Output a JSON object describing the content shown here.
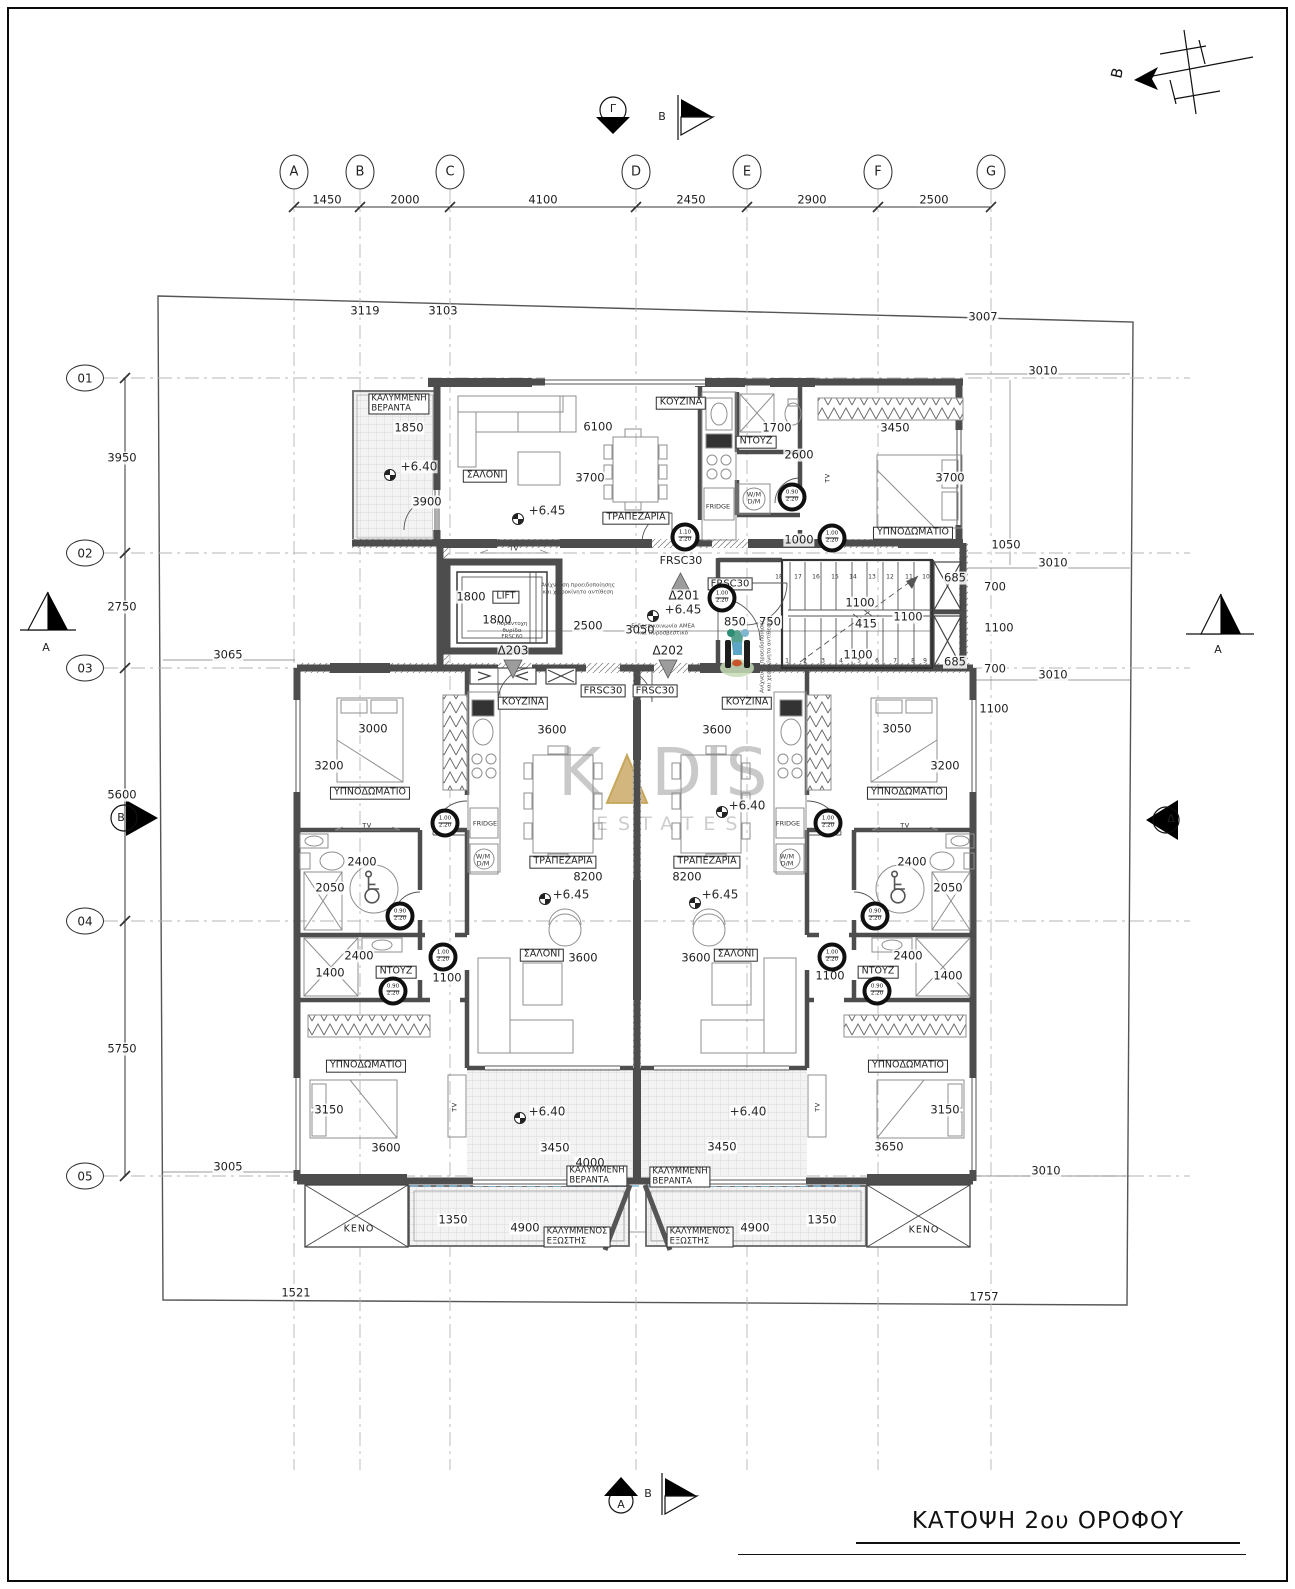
{
  "sheet": {
    "title": "ΚΑΤΟΨΗ 2ου ΟΡΟΦΟΥ"
  },
  "watermark": {
    "word_start": "K",
    "word_end": "DIS",
    "subtitle": "ESTATES"
  },
  "north_label": "B",
  "grid": {
    "columns": [
      {
        "label": "A",
        "x": 294
      },
      {
        "label": "B",
        "x": 360
      },
      {
        "label": "C",
        "x": 450
      },
      {
        "label": "D",
        "x": 636
      },
      {
        "label": "E",
        "x": 747
      },
      {
        "label": "F",
        "x": 878
      },
      {
        "label": "G",
        "x": 991
      }
    ],
    "rows": [
      {
        "label": "01",
        "y": 378
      },
      {
        "label": "02",
        "y": 553
      },
      {
        "label": "03",
        "y": 668
      },
      {
        "label": "04",
        "y": 921
      },
      {
        "label": "05",
        "y": 1176
      }
    ]
  },
  "stairs": {
    "top": {
      "y": 577,
      "xs": [
        779,
        798,
        816,
        835,
        853,
        872,
        890,
        909,
        926
      ],
      "nums": [
        "18",
        "17",
        "16",
        "15",
        "14",
        "13",
        "12",
        "11",
        "10"
      ]
    },
    "bottom": {
      "y": 661,
      "xs": [
        787,
        805,
        823,
        841,
        859,
        877,
        895,
        913,
        925
      ],
      "nums": [
        "1",
        "2",
        "3",
        "4",
        "5",
        "6",
        "7",
        "8",
        "9"
      ]
    }
  },
  "door_circles": [
    {
      "x": 685,
      "y": 537,
      "a": "1.10",
      "b": "2.20"
    },
    {
      "x": 792,
      "y": 497,
      "a": "0.90",
      "b": "2.20"
    },
    {
      "x": 832,
      "y": 538,
      "a": "1.00",
      "b": "2.20"
    },
    {
      "x": 722,
      "y": 598,
      "a": "1.00",
      "b": "2.20"
    },
    {
      "x": 445,
      "y": 823,
      "a": "1.00",
      "b": "2.20"
    },
    {
      "x": 400,
      "y": 916,
      "a": "0.90",
      "b": "2.20"
    },
    {
      "x": 443,
      "y": 957,
      "a": "1.00",
      "b": "2.20"
    },
    {
      "x": 393,
      "y": 991,
      "a": "0.90",
      "b": "2.20"
    },
    {
      "x": 828,
      "y": 823,
      "a": "1.00",
      "b": "2.20"
    },
    {
      "x": 875,
      "y": 916,
      "a": "0.90",
      "b": "2.20"
    },
    {
      "x": 832,
      "y": 957,
      "a": "1.00",
      "b": "2.20"
    },
    {
      "x": 877,
      "y": 991,
      "a": "0.90",
      "b": "2.20"
    }
  ],
  "labels": [
    {
      "t": "1450",
      "x": 327,
      "y": 200,
      "c": "dim"
    },
    {
      "t": "2000",
      "x": 405,
      "y": 200,
      "c": "dim"
    },
    {
      "t": "4100",
      "x": 543,
      "y": 200,
      "c": "dim"
    },
    {
      "t": "2450",
      "x": 691,
      "y": 200,
      "c": "dim"
    },
    {
      "t": "2900",
      "x": 812,
      "y": 200,
      "c": "dim"
    },
    {
      "t": "2500",
      "x": 934,
      "y": 200,
      "c": "dim"
    },
    {
      "t": "3119",
      "x": 365,
      "y": 311,
      "c": "dim"
    },
    {
      "t": "3103",
      "x": 443,
      "y": 311,
      "c": "dim"
    },
    {
      "t": "3007",
      "x": 983,
      "y": 317,
      "c": "dim"
    },
    {
      "t": "3950",
      "x": 122,
      "y": 458,
      "c": "dim"
    },
    {
      "t": "2750",
      "x": 122,
      "y": 607,
      "c": "dim"
    },
    {
      "t": "5600",
      "x": 122,
      "y": 795,
      "c": "dim"
    },
    {
      "t": "5750",
      "x": 122,
      "y": 1049,
      "c": "dim"
    },
    {
      "t": "3065",
      "x": 228,
      "y": 655,
      "c": "dim"
    },
    {
      "t": "3005",
      "x": 228,
      "y": 1167,
      "c": "dim"
    },
    {
      "t": "3010",
      "x": 1043,
      "y": 371,
      "c": "dim"
    },
    {
      "t": "1050",
      "x": 1006,
      "y": 545,
      "c": "dim"
    },
    {
      "t": "3010",
      "x": 1053,
      "y": 563,
      "c": "dim"
    },
    {
      "t": "3010",
      "x": 1053,
      "y": 675,
      "c": "dim"
    },
    {
      "t": "1100",
      "x": 994,
      "y": 709,
      "c": "dim"
    },
    {
      "t": "3010",
      "x": 1046,
      "y": 1171,
      "c": "dim"
    },
    {
      "t": "685",
      "x": 955,
      "y": 578,
      "c": "dim"
    },
    {
      "t": "700",
      "x": 995,
      "y": 587,
      "c": "dim"
    },
    {
      "t": "1100",
      "x": 999,
      "y": 628,
      "c": "dim"
    },
    {
      "t": "685",
      "x": 955,
      "y": 662,
      "c": "dim"
    },
    {
      "t": "700",
      "x": 995,
      "y": 669,
      "c": "dim"
    },
    {
      "t": "ΚΑΛΥΜΜΕΝΗ\nΒΕΡΑΝΤΑ",
      "x": 399,
      "y": 404,
      "c": "room2"
    },
    {
      "t": "1850",
      "x": 409,
      "y": 428,
      "c": "dim"
    },
    {
      "t": "+6.40",
      "x": 419,
      "y": 467,
      "c": "lvl"
    },
    {
      "t": "3900",
      "x": 427,
      "y": 502,
      "c": "dim"
    },
    {
      "t": "ΣΑΛΟΝΙ",
      "x": 485,
      "y": 476,
      "c": "room"
    },
    {
      "t": "6100",
      "x": 598,
      "y": 427,
      "c": "dim"
    },
    {
      "t": "3700",
      "x": 590,
      "y": 478,
      "c": "dim"
    },
    {
      "t": "+6.45",
      "x": 547,
      "y": 511,
      "c": "lvl"
    },
    {
      "t": "ΤΡΑΠΕΖΑΡΙΑ",
      "x": 636,
      "y": 518,
      "c": "room"
    },
    {
      "t": "TV",
      "x": 514,
      "y": 549,
      "c": "tv"
    },
    {
      "t": "ΚΟΥΖΙΝΑ",
      "x": 681,
      "y": 403,
      "c": "room"
    },
    {
      "t": "1700",
      "x": 777,
      "y": 428,
      "c": "dim"
    },
    {
      "t": "ΝΤΟΥΖ",
      "x": 756,
      "y": 442,
      "c": "room"
    },
    {
      "t": "2600",
      "x": 799,
      "y": 455,
      "c": "dim"
    },
    {
      "t": "3450",
      "x": 895,
      "y": 428,
      "c": "dim"
    },
    {
      "t": "3700",
      "x": 950,
      "y": 478,
      "c": "dim"
    },
    {
      "t": "ΥΠΝΟΔΩΜΑΤΙΟ",
      "x": 913,
      "y": 533,
      "c": "room"
    },
    {
      "t": "1000",
      "x": 799,
      "y": 540,
      "c": "dim"
    },
    {
      "t": "TV",
      "x": 828,
      "y": 478,
      "c": "tv",
      "r": -90
    },
    {
      "t": "FRIDGE",
      "x": 718,
      "y": 507,
      "c": "sm"
    },
    {
      "t": "W/M\nD/M",
      "x": 754,
      "y": 499,
      "c": "sm"
    },
    {
      "t": "FRSC30",
      "x": 681,
      "y": 561,
      "c": "frsc"
    },
    {
      "t": "FRSC30",
      "x": 730,
      "y": 584,
      "c": "frscb"
    },
    {
      "t": "1800",
      "x": 471,
      "y": 597,
      "c": "dim"
    },
    {
      "t": "LIFT",
      "x": 506,
      "y": 597,
      "c": "room"
    },
    {
      "t": "1800",
      "x": 497,
      "y": 620,
      "c": "dim"
    },
    {
      "t": "2500",
      "x": 588,
      "y": 626,
      "c": "dim"
    },
    {
      "t": "3050",
      "x": 640,
      "y": 630,
      "c": "dim"
    },
    {
      "t": "Δ201",
      "x": 684,
      "y": 596,
      "c": "door"
    },
    {
      "t": "+6.45",
      "x": 683,
      "y": 610,
      "c": "lvl"
    },
    {
      "t": "850",
      "x": 735,
      "y": 622,
      "c": "dim"
    },
    {
      "t": "750",
      "x": 770,
      "y": 622,
      "c": "dim"
    },
    {
      "t": "Ανίχνευση προειδοποίησης\nκαι χειροκίνητο αντίθεση",
      "x": 578,
      "y": 589,
      "c": "tny"
    },
    {
      "t": "Πυράντοχη\nθυρίδα\nFRSC60",
      "x": 512,
      "y": 631,
      "c": "tny"
    },
    {
      "t": "Ενδοεπικοινωνία ΑΜΕΑ\nκαι Πυροσβεστικό",
      "x": 663,
      "y": 630,
      "c": "tny"
    },
    {
      "t": "Ανίχνευση προειδοποίησης\nκαι χειροκίνητο αντίθεση",
      "x": 766,
      "y": 656,
      "c": "tny",
      "r": -90
    },
    {
      "t": "Δ203",
      "x": 513,
      "y": 651,
      "c": "door"
    },
    {
      "t": "Δ202",
      "x": 668,
      "y": 651,
      "c": "door"
    },
    {
      "t": "1100",
      "x": 860,
      "y": 603,
      "c": "dim"
    },
    {
      "t": "415",
      "x": 866,
      "y": 624,
      "c": "dim"
    },
    {
      "t": "1100",
      "x": 908,
      "y": 617,
      "c": "dim"
    },
    {
      "t": "1100",
      "x": 858,
      "y": 655,
      "c": "dim"
    },
    {
      "t": "FRSC30",
      "x": 603,
      "y": 691,
      "c": "frscb"
    },
    {
      "t": "FRSC30",
      "x": 655,
      "y": 691,
      "c": "frscb"
    },
    {
      "t": "ΚΟΥΖΙΝΑ",
      "x": 523,
      "y": 703,
      "c": "room"
    },
    {
      "t": "3600",
      "x": 552,
      "y": 730,
      "c": "dim"
    },
    {
      "t": "ΚΟΥΖΙΝΑ",
      "x": 747,
      "y": 703,
      "c": "room"
    },
    {
      "t": "3600",
      "x": 717,
      "y": 730,
      "c": "dim"
    },
    {
      "t": "3000",
      "x": 373,
      "y": 729,
      "c": "dim"
    },
    {
      "t": "3200",
      "x": 329,
      "y": 766,
      "c": "dim"
    },
    {
      "t": "ΥΠΝΟΔΩΜΑΤΙΟ",
      "x": 370,
      "y": 793,
      "c": "room"
    },
    {
      "t": "TV",
      "x": 367,
      "y": 826,
      "c": "tv"
    },
    {
      "t": "3050",
      "x": 897,
      "y": 729,
      "c": "dim"
    },
    {
      "t": "3200",
      "x": 945,
      "y": 766,
      "c": "dim"
    },
    {
      "t": "ΥΠΝΟΔΩΜΑΤΙΟ",
      "x": 907,
      "y": 793,
      "c": "room"
    },
    {
      "t": "TV",
      "x": 905,
      "y": 826,
      "c": "tv"
    },
    {
      "t": "FRIDGE",
      "x": 485,
      "y": 824,
      "c": "sm"
    },
    {
      "t": "W/M\nD/M",
      "x": 483,
      "y": 861,
      "c": "sm"
    },
    {
      "t": "FRIDGE",
      "x": 788,
      "y": 824,
      "c": "sm"
    },
    {
      "t": "W/M\nD/M",
      "x": 787,
      "y": 861,
      "c": "sm"
    },
    {
      "t": "2400",
      "x": 362,
      "y": 862,
      "c": "dim"
    },
    {
      "t": "2050",
      "x": 330,
      "y": 888,
      "c": "dim"
    },
    {
      "t": "2400",
      "x": 912,
      "y": 862,
      "c": "dim"
    },
    {
      "t": "2050",
      "x": 948,
      "y": 888,
      "c": "dim"
    },
    {
      "t": "ΤΡΑΠΕΖΑΡΙΑ",
      "x": 563,
      "y": 862,
      "c": "room"
    },
    {
      "t": "8200",
      "x": 588,
      "y": 877,
      "c": "dim"
    },
    {
      "t": "ΤΡΑΠΕΖΑΡΙΑ",
      "x": 707,
      "y": 862,
      "c": "room"
    },
    {
      "t": "8200",
      "x": 687,
      "y": 877,
      "c": "dim"
    },
    {
      "t": "+6.45",
      "x": 571,
      "y": 895,
      "c": "lvl"
    },
    {
      "t": "+6.45",
      "x": 720,
      "y": 895,
      "c": "lvl"
    },
    {
      "t": "+6.40",
      "x": 747,
      "y": 806,
      "c": "lvl"
    },
    {
      "t": "2400",
      "x": 359,
      "y": 956,
      "c": "dim"
    },
    {
      "t": "1400",
      "x": 330,
      "y": 973,
      "c": "dim"
    },
    {
      "t": "ΝΤΟΥΖ",
      "x": 396,
      "y": 972,
      "c": "room"
    },
    {
      "t": "1100",
      "x": 447,
      "y": 978,
      "c": "dim"
    },
    {
      "t": "2400",
      "x": 908,
      "y": 956,
      "c": "dim"
    },
    {
      "t": "ΝΤΟΥΖ",
      "x": 878,
      "y": 972,
      "c": "room"
    },
    {
      "t": "1400",
      "x": 948,
      "y": 976,
      "c": "dim"
    },
    {
      "t": "1100",
      "x": 830,
      "y": 976,
      "c": "dim"
    },
    {
      "t": "ΣΑΛΟΝΙ",
      "x": 542,
      "y": 955,
      "c": "room"
    },
    {
      "t": "3600",
      "x": 583,
      "y": 958,
      "c": "dim"
    },
    {
      "t": "3600",
      "x": 696,
      "y": 958,
      "c": "dim"
    },
    {
      "t": "ΣΑΛΟΝΙ",
      "x": 736,
      "y": 955,
      "c": "room"
    },
    {
      "t": "ΥΠΝΟΔΩΜΑΤΙΟ",
      "x": 366,
      "y": 1066,
      "c": "room"
    },
    {
      "t": "3150",
      "x": 329,
      "y": 1110,
      "c": "dim"
    },
    {
      "t": "3600",
      "x": 386,
      "y": 1148,
      "c": "dim"
    },
    {
      "t": "TV",
      "x": 455,
      "y": 1107,
      "c": "tv",
      "r": -90
    },
    {
      "t": "ΥΠΝΟΔΩΜΑΤΙΟ",
      "x": 908,
      "y": 1066,
      "c": "room"
    },
    {
      "t": "3150",
      "x": 945,
      "y": 1110,
      "c": "dim"
    },
    {
      "t": "3650",
      "x": 889,
      "y": 1147,
      "c": "dim"
    },
    {
      "t": "TV",
      "x": 818,
      "y": 1107,
      "c": "tv",
      "r": -90
    },
    {
      "t": "+6.40",
      "x": 547,
      "y": 1112,
      "c": "lvl"
    },
    {
      "t": "+6.40",
      "x": 748,
      "y": 1112,
      "c": "lvl"
    },
    {
      "t": "3450",
      "x": 555,
      "y": 1148,
      "c": "dim"
    },
    {
      "t": "3450",
      "x": 722,
      "y": 1147,
      "c": "dim"
    },
    {
      "t": "4000",
      "x": 590,
      "y": 1163,
      "c": "dim"
    },
    {
      "t": "ΚΑΛΥΜΜΕΝΗ\nΒΕΡΑΝΤΑ",
      "x": 597,
      "y": 1176,
      "c": "room2"
    },
    {
      "t": "ΚΑΛΥΜΜΕΝΗ\nΒΕΡΑΝΤΑ",
      "x": 680,
      "y": 1177,
      "c": "room2"
    },
    {
      "t": "1350",
      "x": 453,
      "y": 1220,
      "c": "dim"
    },
    {
      "t": "4900",
      "x": 525,
      "y": 1228,
      "c": "dim"
    },
    {
      "t": "ΚΑΛΥΜΜΕΝΟΣ\nΕΞΩΣΤΗΣ",
      "x": 577,
      "y": 1237,
      "c": "room2"
    },
    {
      "t": "ΚΑΛΥΜΜΕΝΟΣ\nΕΞΩΣΤΗΣ",
      "x": 700,
      "y": 1237,
      "c": "room2"
    },
    {
      "t": "4900",
      "x": 755,
      "y": 1228,
      "c": "dim"
    },
    {
      "t": "1350",
      "x": 822,
      "y": 1220,
      "c": "dim"
    },
    {
      "t": "KENO",
      "x": 359,
      "y": 1230,
      "c": "plain"
    },
    {
      "t": "KENO",
      "x": 924,
      "y": 1231,
      "c": "plain"
    },
    {
      "t": "1521",
      "x": 296,
      "y": 1293,
      "c": "dim"
    },
    {
      "t": "1757",
      "x": 984,
      "y": 1297,
      "c": "dim"
    },
    {
      "t": "Γ",
      "x": 613,
      "y": 109,
      "c": "mk"
    },
    {
      "t": "B",
      "x": 662,
      "y": 117,
      "c": "mk"
    },
    {
      "t": "A",
      "x": 621,
      "y": 1505,
      "c": "mk"
    },
    {
      "t": "B",
      "x": 648,
      "y": 1494,
      "c": "mk"
    },
    {
      "t": "A",
      "x": 46,
      "y": 648,
      "c": "mk"
    },
    {
      "t": "B",
      "x": 121,
      "y": 818,
      "c": "mk"
    },
    {
      "t": "A",
      "x": 1218,
      "y": 650,
      "c": "mk"
    },
    {
      "t": "Δ",
      "x": 1171,
      "y": 819,
      "c": "mk"
    }
  ]
}
